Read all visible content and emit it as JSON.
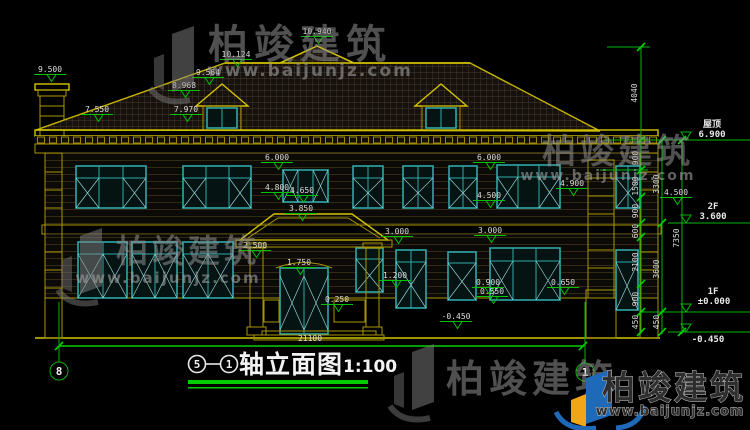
{
  "page": {
    "background": "#000000"
  },
  "colors": {
    "line_yellow": "#a99500",
    "line_green": "#00c800",
    "window_teal": "#2fa8a8",
    "text_white": "#e8e8e8",
    "underline_green": "#00cc00",
    "logo_blue": "#1e6ab8",
    "logo_yellow": "#f0a618"
  },
  "title_block": {
    "axis_from": "5",
    "axis_to": "1",
    "title": "轴立面图",
    "scale": "1:100"
  },
  "axes": {
    "left_bubble": "8",
    "right_bubble": "1"
  },
  "watermark": {
    "brand": "柏竣建筑",
    "url": "www.baijunjz.com"
  },
  "annotations": [
    {
      "name": "elev-chimney",
      "text": "9.500",
      "x": 50,
      "y": 72,
      "marker": true
    },
    {
      "name": "elev-eave-left",
      "text": "7.550",
      "x": 97,
      "y": 112,
      "marker": true
    },
    {
      "name": "elev-ridge-side",
      "text": "10.124",
      "x": 236,
      "y": 57,
      "marker": true
    },
    {
      "name": "elev-dormer-peak",
      "text": "9.564",
      "x": 208,
      "y": 75,
      "marker": true
    },
    {
      "name": "elev-dormer-eave",
      "text": "8.968",
      "x": 184,
      "y": 88,
      "marker": true
    },
    {
      "name": "elev-dormer-sill",
      "text": "7.970",
      "x": 186,
      "y": 112,
      "marker": true
    },
    {
      "name": "elev-ridge-main",
      "text": "10.940",
      "x": 317,
      "y": 34,
      "marker": true
    },
    {
      "name": "elev-6000-left",
      "text": "6.000",
      "x": 277,
      "y": 160,
      "marker": true
    },
    {
      "name": "elev-6000-right",
      "text": "6.000",
      "x": 489,
      "y": 160,
      "marker": true
    },
    {
      "name": "elev-4800",
      "text": "4.800",
      "x": 277,
      "y": 190,
      "marker": true
    },
    {
      "name": "elev-4650",
      "text": "4.650",
      "x": 302,
      "y": 193,
      "marker": true
    },
    {
      "name": "elev-4900",
      "text": "4.900",
      "x": 572,
      "y": 186,
      "marker": true
    },
    {
      "name": "elev-4500-mid",
      "text": "4.500",
      "x": 489,
      "y": 198,
      "marker": true
    },
    {
      "name": "elev-4500-right",
      "text": "4.500",
      "x": 676,
      "y": 195,
      "marker": true
    },
    {
      "name": "elev-porch-roof",
      "text": "3.850",
      "x": 301,
      "y": 211,
      "marker": true
    },
    {
      "name": "elev-3000-a",
      "text": "3.000",
      "x": 397,
      "y": 234,
      "marker": true
    },
    {
      "name": "elev-3000-b",
      "text": "3.000",
      "x": 490,
      "y": 233,
      "marker": true
    },
    {
      "name": "elev-2500",
      "text": "2.500",
      "x": 255,
      "y": 248,
      "marker": true
    },
    {
      "name": "elev-door-top",
      "text": "1.750",
      "x": 299,
      "y": 265,
      "marker": true
    },
    {
      "name": "elev-1200",
      "text": "1.200",
      "x": 395,
      "y": 278,
      "marker": true
    },
    {
      "name": "elev-0250",
      "text": "0.250",
      "x": 337,
      "y": 302,
      "marker": true
    },
    {
      "name": "elev-0900",
      "text": "0.900",
      "x": 488,
      "y": 285,
      "marker": true
    },
    {
      "name": "elev-0550",
      "text": "0.550",
      "x": 492,
      "y": 294,
      "marker": true
    },
    {
      "name": "elev-0650",
      "text": "0.650",
      "x": 563,
      "y": 285,
      "marker": true
    },
    {
      "name": "elev-neg0450-left",
      "text": "-0.450",
      "x": 456,
      "y": 319,
      "marker": true
    },
    {
      "name": "dim-total-width",
      "text": "21100",
      "x": 310,
      "y": 341
    },
    {
      "name": "dim-4040",
      "text": "4040",
      "x": 637,
      "y": 93,
      "rot": -90
    },
    {
      "name": "dim-900-a",
      "text": "900",
      "x": 638,
      "y": 158,
      "rot": -90
    },
    {
      "name": "dim-1500",
      "text": "1500",
      "x": 638,
      "y": 186,
      "rot": -90
    },
    {
      "name": "dim-900-b",
      "text": "900",
      "x": 638,
      "y": 211,
      "rot": -90
    },
    {
      "name": "dim-600",
      "text": "600",
      "x": 638,
      "y": 231,
      "rot": -90
    },
    {
      "name": "dim-2100",
      "text": "2100",
      "x": 638,
      "y": 262,
      "rot": -90
    },
    {
      "name": "dim-900-c",
      "text": "900",
      "x": 638,
      "y": 299,
      "rot": -90
    },
    {
      "name": "dim-450-a",
      "text": "450",
      "x": 638,
      "y": 322,
      "rot": -90
    },
    {
      "name": "dim-3300",
      "text": "3300",
      "x": 659,
      "y": 184,
      "rot": -90
    },
    {
      "name": "dim-3600",
      "text": "3600",
      "x": 659,
      "y": 269,
      "rot": -90
    },
    {
      "name": "dim-450-b",
      "text": "450",
      "x": 659,
      "y": 322,
      "rot": -90
    },
    {
      "name": "dim-7350",
      "text": "7350",
      "x": 679,
      "y": 238,
      "rot": -90
    },
    {
      "name": "level-roof-label",
      "text": "屋顶",
      "x": 712,
      "y": 127,
      "cls": "lvl"
    },
    {
      "name": "level-roof-value",
      "text": "6.900",
      "x": 712,
      "y": 137,
      "cls": "lvl"
    },
    {
      "name": "level-2f-label",
      "text": "2F",
      "x": 713,
      "y": 209,
      "cls": "lvl"
    },
    {
      "name": "level-2f-value",
      "text": "3.600",
      "x": 713,
      "y": 219,
      "cls": "lvl"
    },
    {
      "name": "level-1f-label",
      "text": "1F",
      "x": 713,
      "y": 294,
      "cls": "lvl"
    },
    {
      "name": "level-1f-value",
      "text": "±0.000",
      "x": 714,
      "y": 304,
      "cls": "lvl"
    },
    {
      "name": "level-base-value",
      "text": "-0.450",
      "x": 708,
      "y": 342,
      "cls": "lvl"
    }
  ]
}
